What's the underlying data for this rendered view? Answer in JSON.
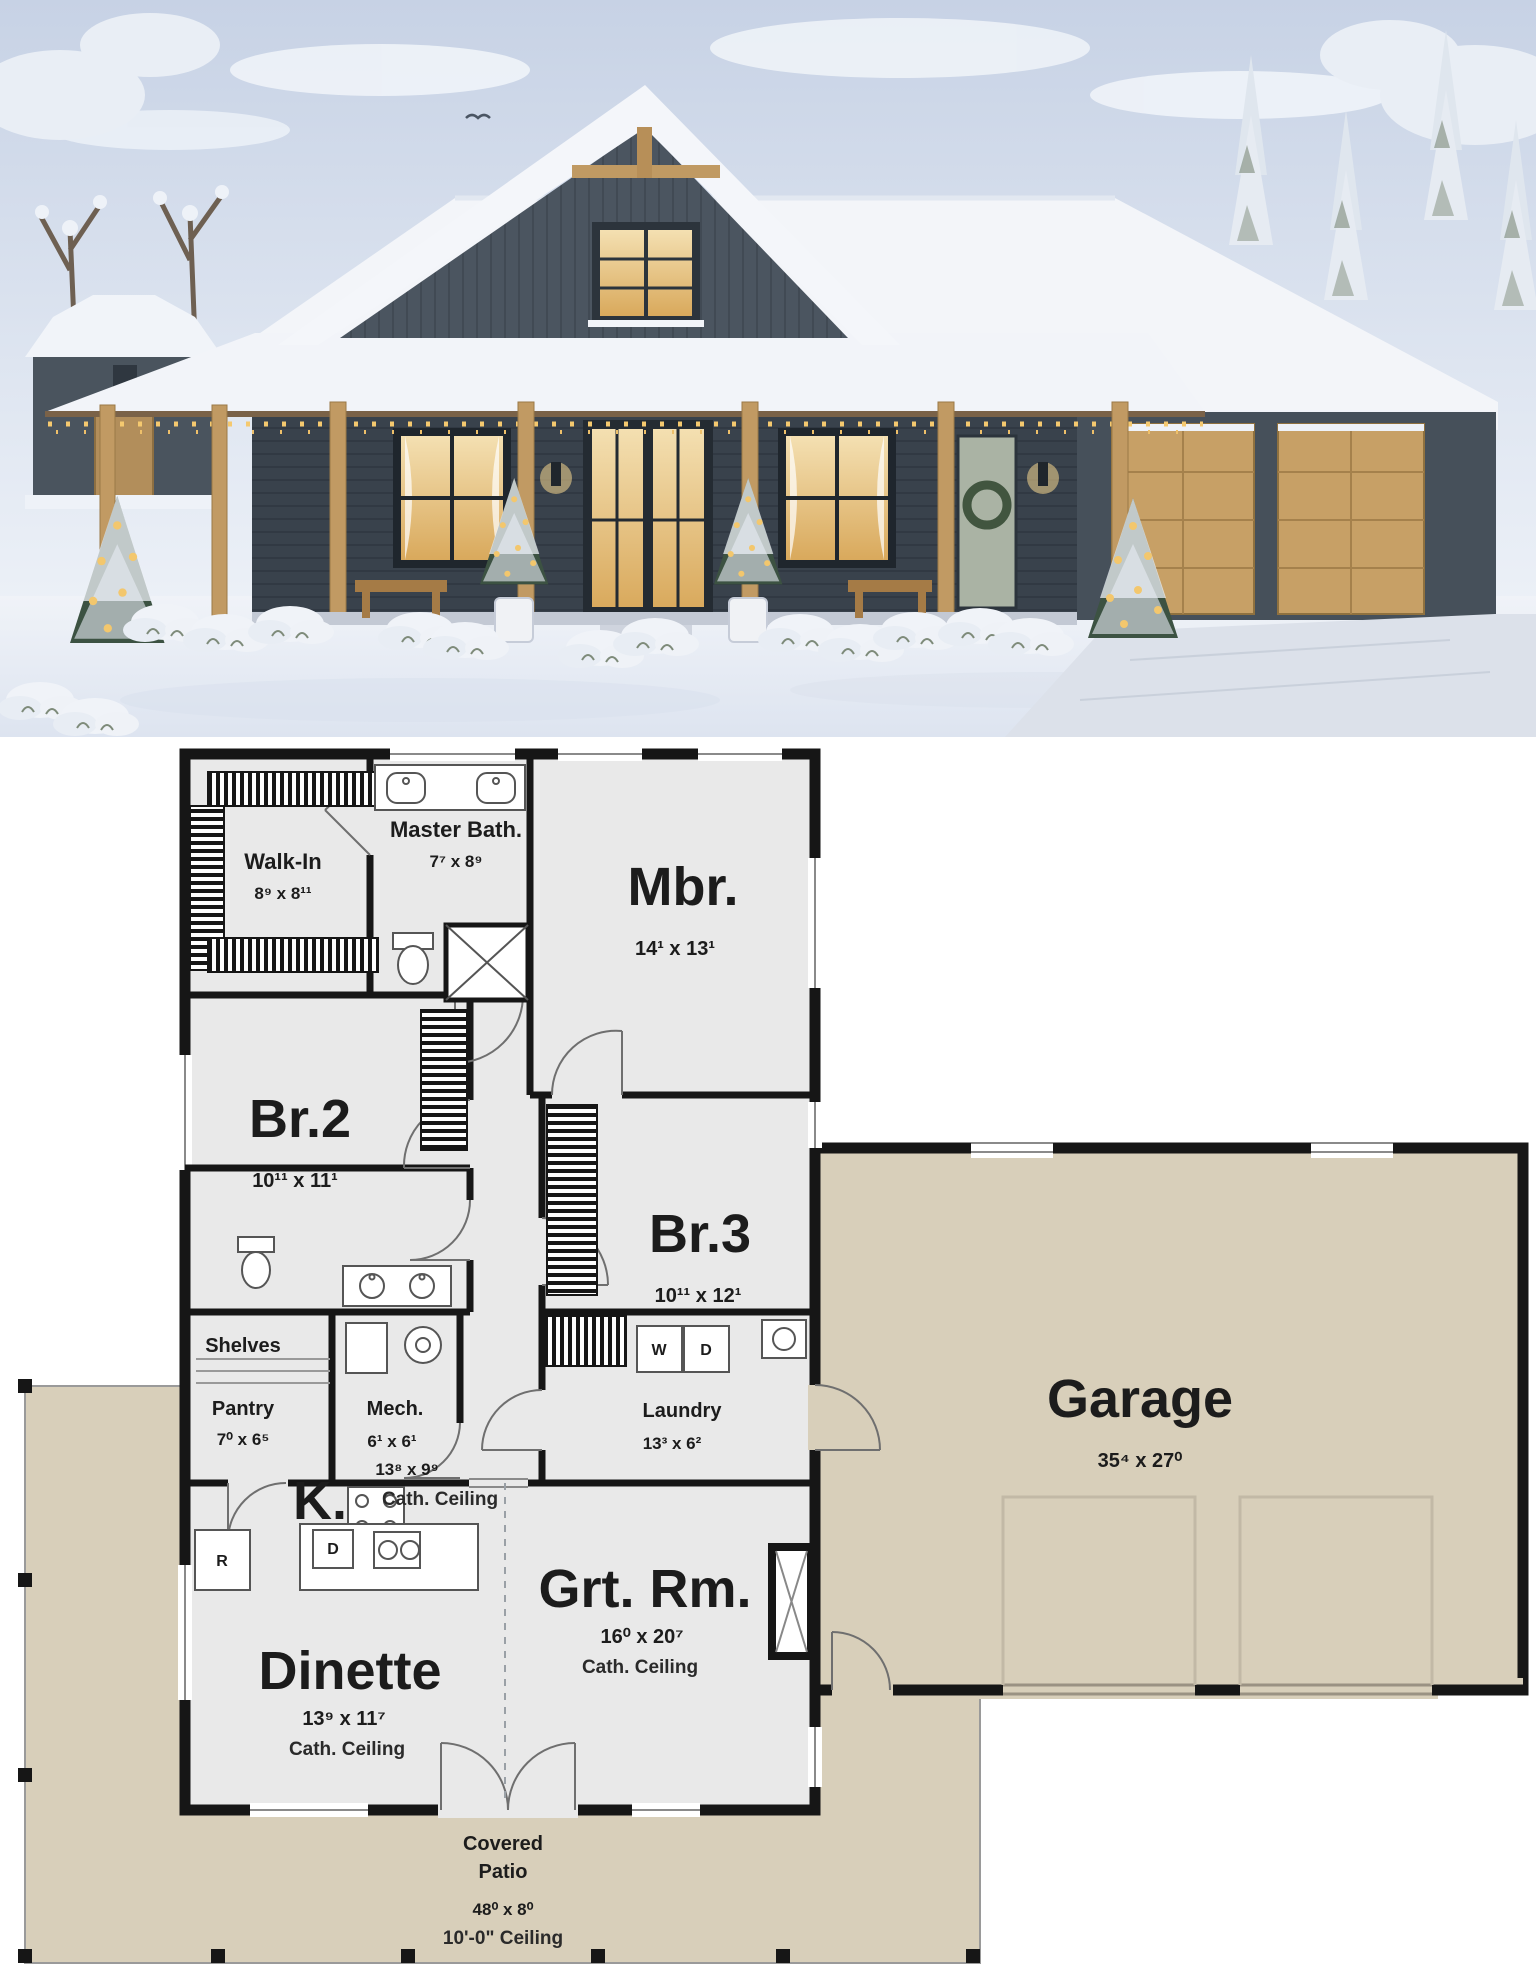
{
  "photo": {
    "scene": "snow-covered modern farmhouse with wrap porch, christmas trees and attached garage",
    "colors": {
      "sky": "#c9d4e6",
      "siding": "#46505a",
      "roof_snow": "#f3f5f9",
      "wood": "#c19a63",
      "window_glow": "#eed2a0",
      "snow": "#edf1f7"
    }
  },
  "floor_plan": {
    "colors": {
      "wall": "#161616",
      "room_fill": "#e9e9e9",
      "garage_fill": "#d8cfba",
      "patio_fill": "#d8cfba"
    },
    "rooms": {
      "walk_in": {
        "name": "Walk-In",
        "dims": "8⁹ x 8¹¹"
      },
      "master_bath": {
        "name": "Master Bath.",
        "dims": "7⁷ x 8⁹"
      },
      "mbr": {
        "name": "Mbr.",
        "dims": "14¹ x 13¹"
      },
      "br2": {
        "name": "Br.2",
        "dims": "10¹¹ x 11¹"
      },
      "br3": {
        "name": "Br.3",
        "dims": "10¹¹ x 12¹"
      },
      "shelves": "Shelves",
      "pantry": {
        "name": "Pantry",
        "dims": "7⁰ x 6⁵"
      },
      "mech": {
        "name": "Mech.",
        "dims": "6¹ x 6¹"
      },
      "laundry": {
        "name": "Laundry",
        "dims": "13³ x 6²"
      },
      "kitchen": {
        "name": "K.",
        "dims": "13⁸ x 9⁹",
        "ceiling": "Cath. Ceiling"
      },
      "grt_rm": {
        "name": "Grt. Rm.",
        "dims": "16⁰ x 20⁷",
        "ceiling": "Cath. Ceiling"
      },
      "dinette": {
        "name": "Dinette",
        "dims": "13⁹ x 11⁷",
        "ceiling": "Cath. Ceiling"
      },
      "garage": {
        "name": "Garage",
        "dims": "35⁴ x 27⁰"
      },
      "patio": {
        "line1": "Covered",
        "line2": "Patio",
        "dims": "48⁰ x 8⁰",
        "ceiling": "10'-0\" Ceiling"
      }
    },
    "appliances": {
      "washer": "W",
      "dryer": "D",
      "refrigerator": "R",
      "dishwasher": "D"
    }
  }
}
